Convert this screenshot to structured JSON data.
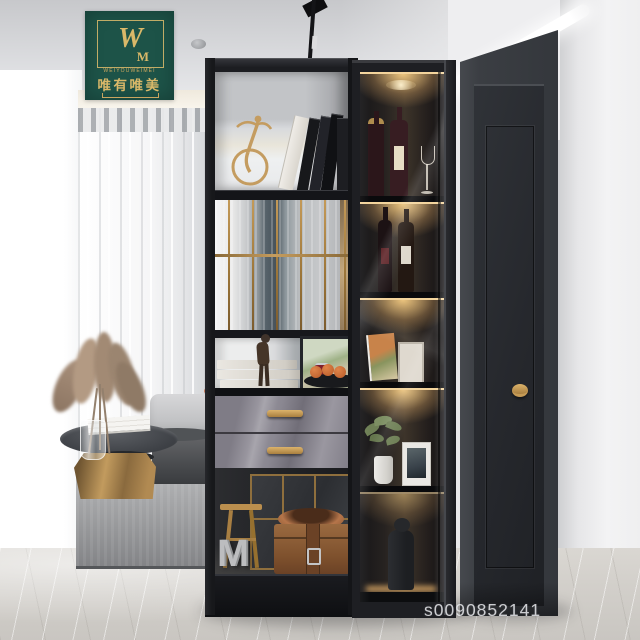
{
  "brand_badge": {
    "monogram_primary": "W",
    "monogram_secondary": "M",
    "latin_name": "WEIYOUWEIMEI",
    "chinese_name": "唯有唯美"
  },
  "watermark": {
    "text": "s0090852141"
  },
  "shelf_decor": {
    "letter": "M"
  },
  "colors": {
    "logo_green": "#1d5348",
    "logo_gold": "#d9b869",
    "gold_bright": "#c59a55",
    "cabinet_black": "#1a1b1e",
    "led_warm": "#f0cb92",
    "drawer_gray": "#8b8892",
    "door_charcoal": "#36393e",
    "wall_white": "#f2f2f3",
    "ceiling_gray": "#d4d5d7",
    "floor_marble": "#d6d3ce",
    "rug_gray": "#a2a3a5",
    "box_brown": "#8a5a36",
    "fruit_orange": "#cf7038",
    "plant_green": "#71825a"
  }
}
